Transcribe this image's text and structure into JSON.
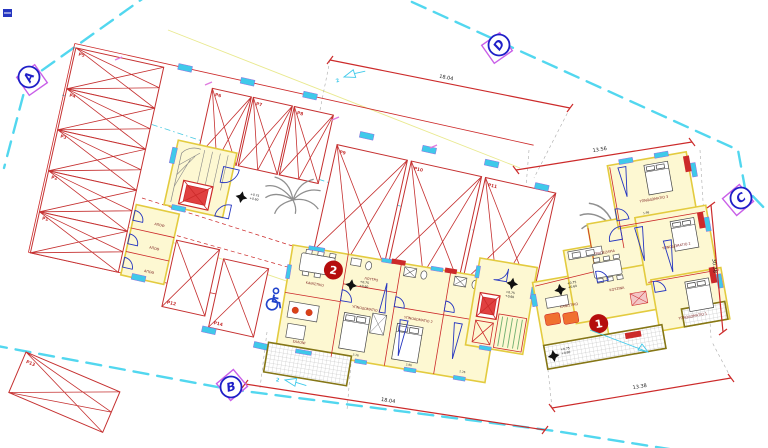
{
  "plan": {
    "grid_markers": [
      {
        "label": "A"
      },
      {
        "label": "B"
      },
      {
        "label": "C"
      },
      {
        "label": "D"
      }
    ],
    "dimensions": {
      "top": "18.04",
      "bottom": "18.04",
      "right_top": "13.56",
      "right_side": "30.38",
      "bottom_right": "13.38"
    },
    "room_dims": [
      "3.26",
      "2.86",
      "2.26",
      "1.98"
    ],
    "levels": {
      "upper": "+0.75",
      "lower": "+0.60"
    },
    "parking": {
      "labels": [
        "P1",
        "P2",
        "P3",
        "P4",
        "P5",
        "P6",
        "P7",
        "P8",
        "P9",
        "P10",
        "P11",
        "P12",
        "P13",
        "P14"
      ]
    },
    "storage": {
      "label": "ΑΠΟΘ"
    },
    "units": [
      {
        "number": "1",
        "rooms": [
          {
            "label": "ΚΑΘΙΣΤΙΚΟ"
          },
          {
            "label": "ΤΡΑΠΕΖΑΡΙΑ"
          },
          {
            "label": "ΚΟΥΖΙΝΑ"
          },
          {
            "label": "ΥΠΝΟΔΩΜΑΤΙΟ 1"
          },
          {
            "label": "ΥΠΝΟΔΩΜΑΤΙΟ 2"
          },
          {
            "label": "ΥΠΝΟΔΩΜΑΤΙΟ 3"
          }
        ]
      },
      {
        "number": "2",
        "rooms": [
          {
            "label": "ΚΑΘΙΣΤΙΚΟ"
          },
          {
            "label": "ΣΑΛΟΝΙ"
          },
          {
            "label": "ΛΟΥΤΡΟ"
          },
          {
            "label": "ΥΠΝΟΔΩΜΑΤΙΟ 1"
          },
          {
            "label": "ΥΠΝΟΔΩΜΑΤΙΟ 2"
          }
        ]
      }
    ],
    "section_arrows": {
      "label": "2"
    },
    "icons": {
      "wheelchair": "♿",
      "palm_tree": "palm-tree",
      "level_star": "✦"
    },
    "colors": {
      "boundary": "#52d7ef",
      "parking_red": "#c53030",
      "wall_yellow": "#fdf8d2",
      "wall_edge": "#e3cb3f",
      "marker_blue": "#1f1fc8",
      "marker_diamond": "#c95fe8",
      "badge_red": "#b50d0d",
      "window_cyan": "#3fc9ea",
      "fixture_blue": "#2535c0",
      "stair_green": "#6fae6f",
      "balcony_olive": "#857616"
    }
  }
}
